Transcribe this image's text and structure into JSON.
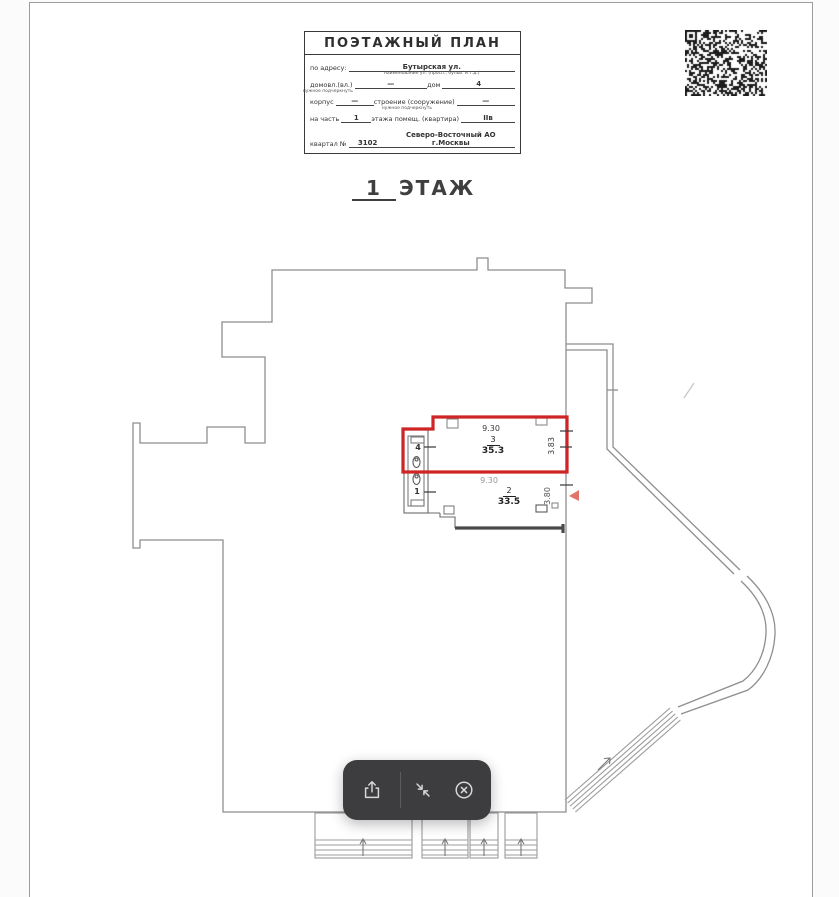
{
  "title_block": {
    "title": "ПОЭТАЖНЫЙ ПЛАН",
    "address_label": "по адресу:",
    "address_value": "Бутырская ул.",
    "address_caption": "наименование ул. (просп., бульв. и т.д.)",
    "ownership_label": "домовл.(вл.)",
    "ownership_caption": "нужное подчеркнуть",
    "ownership_value": "—",
    "house_label": "дом",
    "house_value": "4",
    "building_label": "корпус",
    "building_value": "—",
    "structure_label": "строение (сооружение)",
    "structure_caption": "нужное подчеркнуть",
    "structure_value": "—",
    "part_label": "на часть",
    "part_value": "1",
    "floor_suffix_label": "этажа помещ. (квартира)",
    "apartment_value": "IIв",
    "block_label": "квартал №",
    "block_value": "3102",
    "district_value": "Северо-Восточный АО г.Москвы"
  },
  "floor_heading": {
    "number": "1",
    "label": "ЭТАЖ"
  },
  "plan": {
    "highlight_color": "#cf2526",
    "rooms": [
      {
        "number": "3",
        "area": "35.3",
        "width": "9.30",
        "depth": "3.83",
        "highlighted": true
      },
      {
        "number": "2",
        "area": "33.5",
        "width": "9.30",
        "depth": "3.80",
        "highlighted": false
      },
      {
        "number": "4"
      },
      {
        "number": "1"
      }
    ]
  },
  "toolbar": {
    "background": "#3d3d3f",
    "buttons": [
      {
        "icon": "share-icon"
      },
      {
        "icon": "collapse-icon"
      },
      {
        "icon": "close-circle-icon"
      }
    ]
  }
}
